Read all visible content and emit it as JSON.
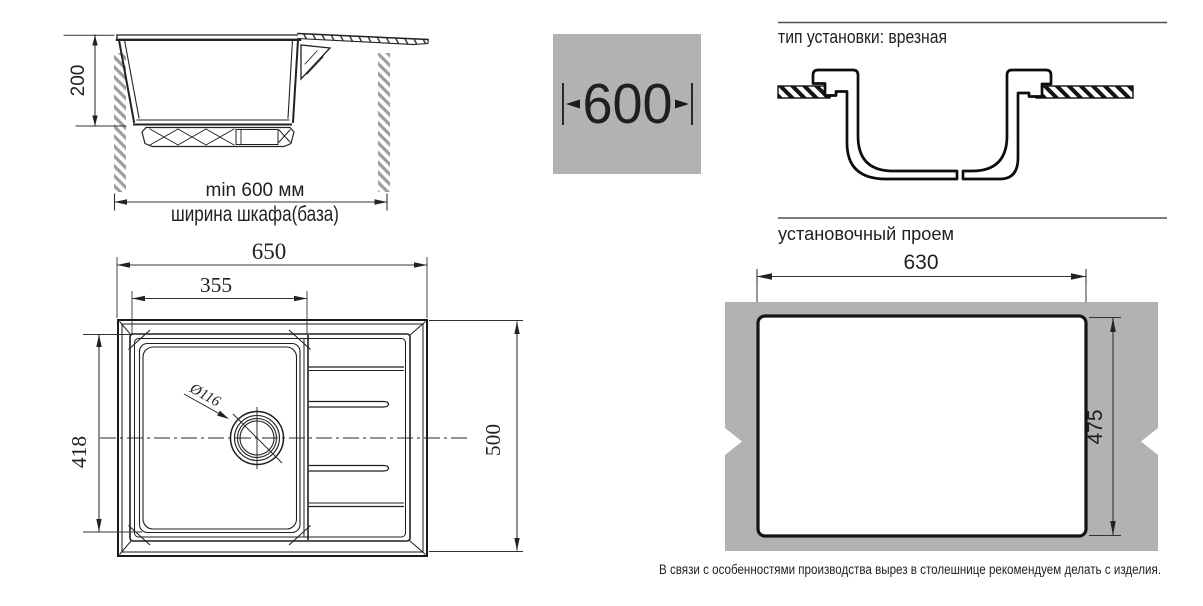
{
  "colors": {
    "line": "#1f1f1f",
    "drawing_line": "#222222",
    "profile_line": "#0d0d0d",
    "gray_fill": "#b2b2b2",
    "hatch_gray": "#9d9d9d",
    "rule": "#515151"
  },
  "cabinet_section": {
    "depth": "200",
    "min_width": "min 600 мм",
    "cabinet_width_label": "ширина шкафа(база)"
  },
  "cabinet_width_badge": {
    "value": "600"
  },
  "installation": {
    "type_heading": "тип установки: врезная",
    "opening_heading": "установочный проем",
    "opening_width": "630",
    "opening_depth": "475",
    "note": "В связи с особенностями производства вырез в столешнице рекомендуем делать с изделия."
  },
  "sink_top_view": {
    "overall_width": "650",
    "bowl_width": "355",
    "bowl_depth": "418",
    "overall_depth": "500",
    "drain_diameter": "Ø116"
  }
}
